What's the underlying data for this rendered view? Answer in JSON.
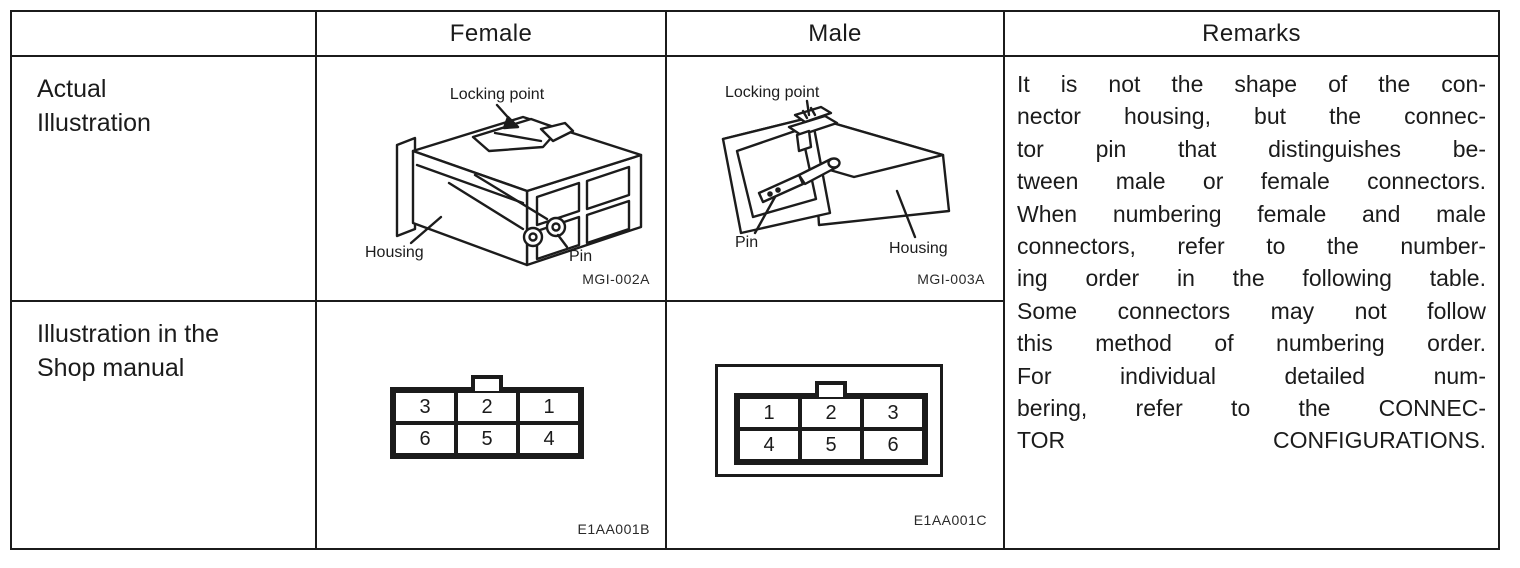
{
  "page": {
    "background": "#ffffff",
    "ink": "#1b1b1b"
  },
  "table": {
    "headers": {
      "col1": "",
      "col2": "Female",
      "col3": "Male",
      "col4": "Remarks"
    },
    "row_labels": {
      "actual": {
        "line1": "Actual",
        "line2": "Illustration"
      },
      "shop": {
        "line1": "Illustration in the",
        "line2": "Shop manual"
      }
    }
  },
  "female_actual": {
    "locking_point_label": "Locking point",
    "housing_label": "Housing",
    "pin_label": "Pin",
    "figure_code": "MGI-002A"
  },
  "male_actual": {
    "locking_point_label": "Locking point",
    "pin_label": "Pin",
    "housing_label": "Housing",
    "figure_code": "MGI-003A"
  },
  "female_shop": {
    "pins": [
      [
        "3",
        "2",
        "1"
      ],
      [
        "6",
        "5",
        "4"
      ]
    ],
    "figure_code": "E1AA001B"
  },
  "male_shop": {
    "pins": [
      [
        "1",
        "2",
        "3"
      ],
      [
        "4",
        "5",
        "6"
      ]
    ],
    "figure_code": "E1AA001C"
  },
  "remarks": {
    "lines": [
      "It is not the shape of the con-",
      "nector housing, but the connec-",
      "tor pin that distinguishes be-",
      "tween male or female connectors.",
      "When numbering female and male",
      "connectors, refer to the number-",
      "ing order in the following table.",
      "Some connectors may not follow",
      "this method of numbering order.",
      "For individual detailed num-",
      "bering, refer to the CONNEC-",
      "TOR CONFIGURATIONS."
    ]
  }
}
